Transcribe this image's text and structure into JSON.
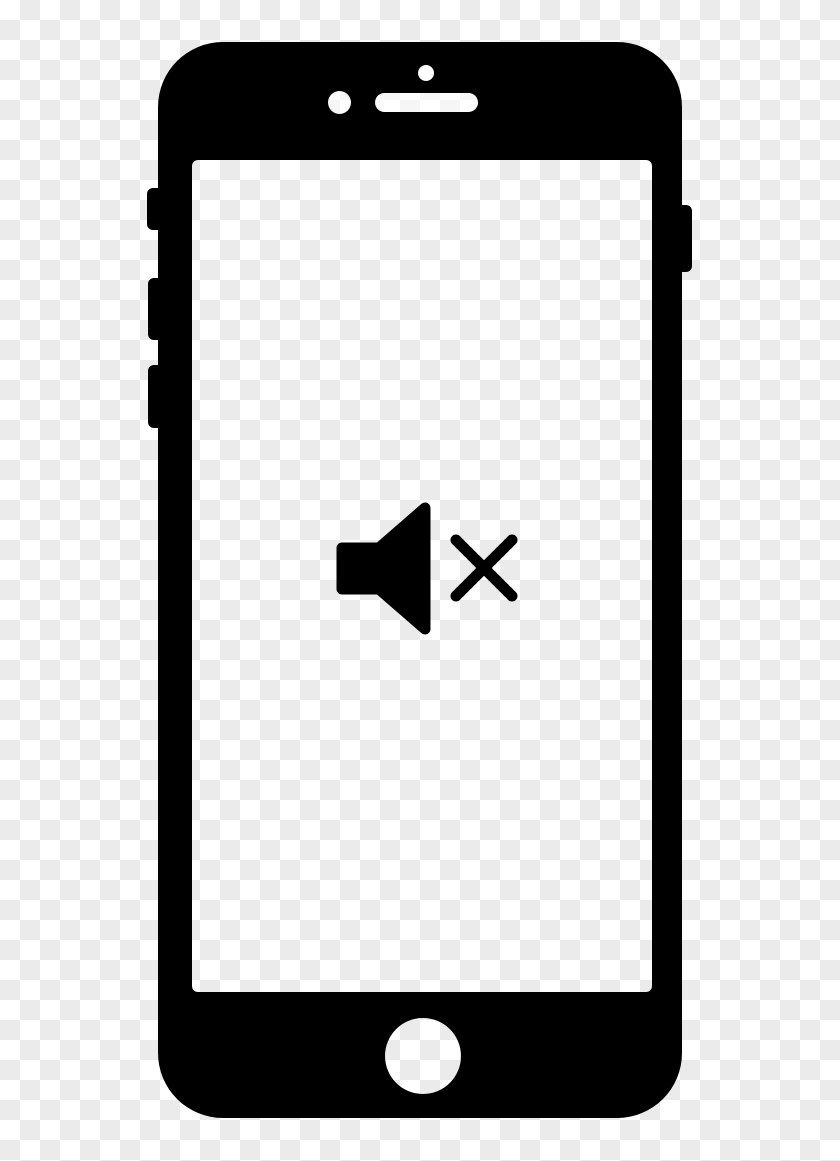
{
  "title": "Smartphone with muted volume clipart icon",
  "canvas": {
    "width_px": 840,
    "height_px": 1161
  },
  "background": {
    "style": "transparency-checkerboard",
    "square_size_px": 20,
    "light_color": "#ffffff",
    "dark_color": "#ebebeb"
  },
  "phone": {
    "silhouette_color": "#000000",
    "labels": {
      "phone": "black smartphone outline",
      "screen": "empty transparent phone screen",
      "mute_switch": "mute switch side button",
      "volume_up": "volume up side button",
      "volume_down": "volume down side button",
      "power": "power side button",
      "sensor": "proximity sensor dot",
      "camera": "front camera dot",
      "earpiece": "earpiece speaker slot",
      "home": "home button circle",
      "mute_icon": "muted speaker with cross mark",
      "speaker": "speaker glyph",
      "cross": "cross (x) mark glyph"
    }
  }
}
